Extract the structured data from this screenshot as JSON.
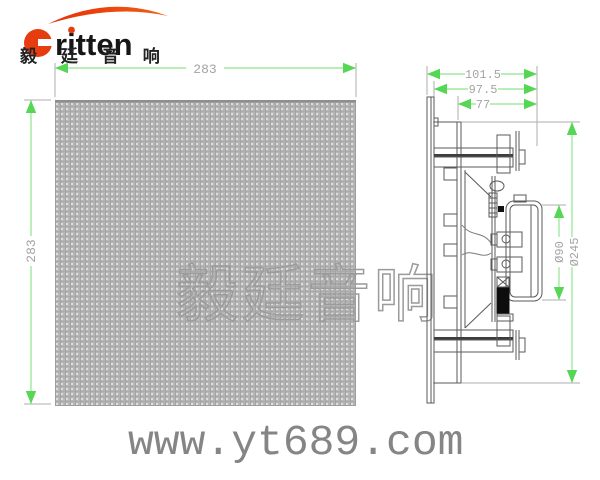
{
  "logo": {
    "brand_latin": "ritten",
    "brand_cn": "毅 廷 音 响",
    "accent_color": "#e63c10"
  },
  "dims": {
    "front_width": "283",
    "front_height": "283",
    "side_depth_overall": "101.5",
    "side_depth_body": "97.5",
    "side_depth_inner": "77",
    "magnet_diameter": "Ø90",
    "cutout_diameter": "Ø245"
  },
  "watermark": {
    "text": "毅廷音响"
  },
  "footer": {
    "website": "www.yt689.com"
  },
  "colors": {
    "dimension_line": "#8ee58e",
    "dimension_arrow": "#55d655",
    "dimension_text": "#a4a4a4",
    "extension_line": "#aeaeae",
    "drawing_line": "#5a5a5a",
    "grille_fill": "#b5b5b5",
    "website_text": "#858585",
    "watermark_outline": "#9b9b9b"
  }
}
